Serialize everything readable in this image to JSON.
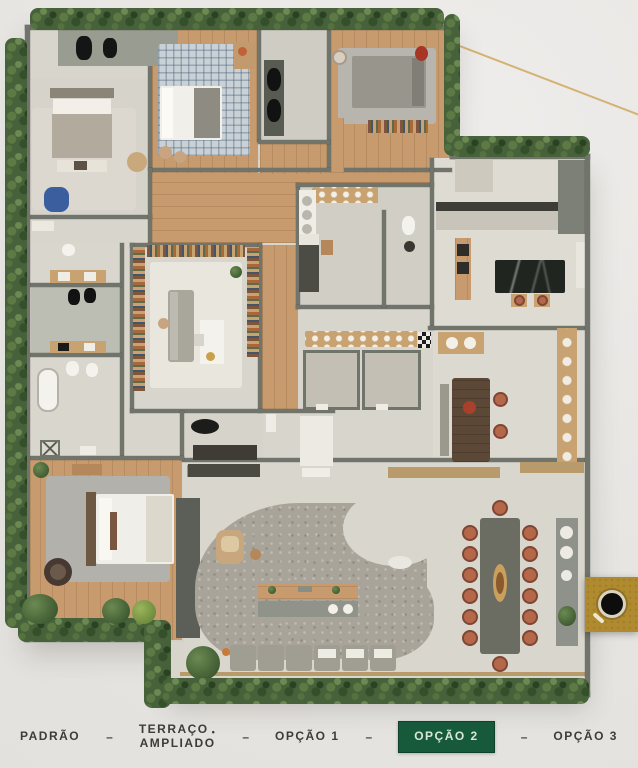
{
  "page": {
    "background": "#e9e7e4"
  },
  "decor": {
    "diagonal_line_color": "#cfa85f"
  },
  "zoom_button": {
    "icon": "magnifier",
    "background": "#b08a2e"
  },
  "floor_plan": {
    "type": "apartment-floor-plan-render",
    "active_option": "OPÇÃO 2",
    "palette": {
      "wall": "#70746a",
      "wood_floor": "#c79b6e",
      "tile_floor": "#d8d5cc",
      "terrace_paving": "#a8a49a",
      "greenery": "#47613a",
      "terracotta_chairs": "#b5674a",
      "marble_island": "#20251f"
    }
  },
  "tabs": {
    "separator": "–",
    "text_color": "#3c3c39",
    "active_bg": "#175a3b",
    "active_text": "#d7e7d8",
    "items": [
      {
        "id": "padrao",
        "label": "PADRÃO",
        "active": false
      },
      {
        "id": "terraco-ampliado",
        "label": "TERRAÇO AMPLIADO",
        "line1": "TERRAÇO",
        "line2": "AMPLIADO",
        "footnote_marker": "•",
        "active": false
      },
      {
        "id": "opcao-1",
        "label": "OPÇÃO 1",
        "active": false
      },
      {
        "id": "opcao-2",
        "label": "OPÇÃO 2",
        "active": true
      },
      {
        "id": "opcao-3",
        "label": "OPÇÃO 3",
        "active": false
      }
    ]
  }
}
